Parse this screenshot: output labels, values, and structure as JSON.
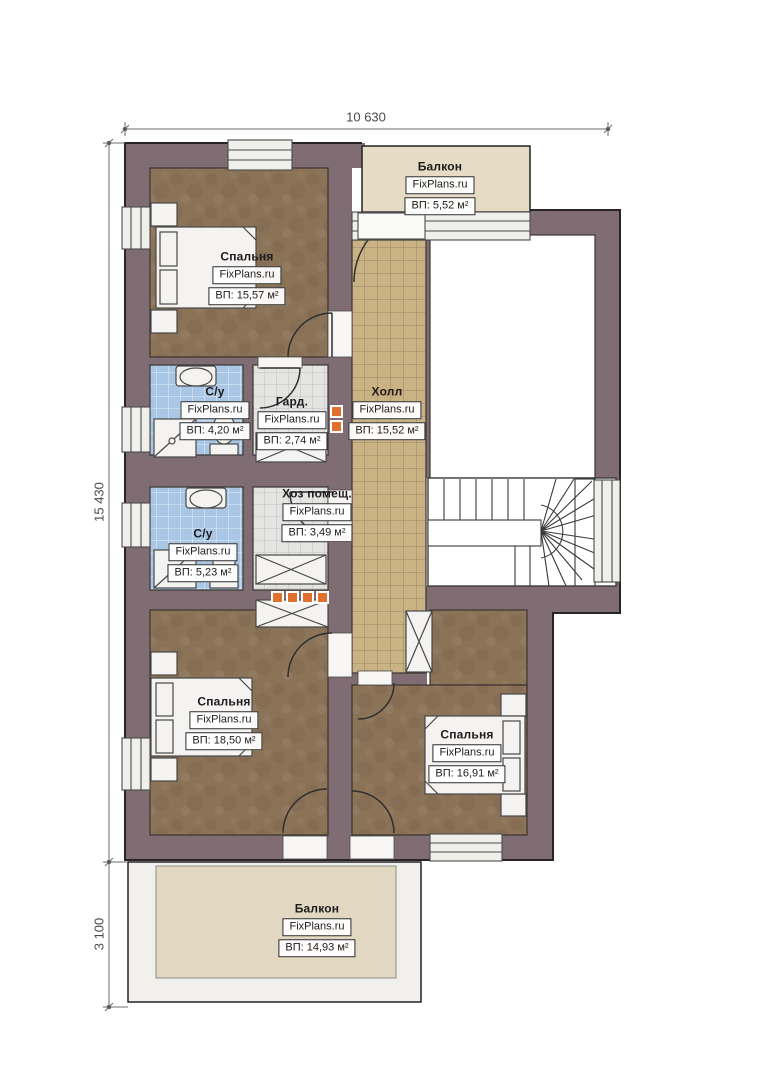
{
  "plan": {
    "dimensions": {
      "top": "10 630",
      "left": "15 430",
      "left_lower": "3 100"
    },
    "rooms": [
      {
        "id": "bedroom-top",
        "name": "Спальня",
        "watermark": "FixPlans.ru",
        "area": "ВП: 15,57 м²"
      },
      {
        "id": "balcony-top",
        "name": "Балкон",
        "watermark": "FixPlans.ru",
        "area": "ВП: 5,52 м²"
      },
      {
        "id": "bathroom-upper",
        "name": "С/у",
        "watermark": "FixPlans.ru",
        "area": "ВП: 4,20 м²"
      },
      {
        "id": "wardrobe",
        "name": "Гард.",
        "watermark": "FixPlans.ru",
        "area": "ВП: 2,74 м²"
      },
      {
        "id": "hall",
        "name": "Холл",
        "watermark": "FixPlans.ru",
        "area": "ВП: 15,52 м²"
      },
      {
        "id": "utility",
        "name": "Хоз помещ.",
        "watermark": "FixPlans.ru",
        "area": "ВП: 3,49 м²"
      },
      {
        "id": "bathroom-lower",
        "name": "С/у",
        "watermark": "FixPlans.ru",
        "area": "ВП: 5,23 м²"
      },
      {
        "id": "bedroom-bottom-left",
        "name": "Спальня",
        "watermark": "FixPlans.ru",
        "area": "ВП: 18,50 м²"
      },
      {
        "id": "bedroom-bottom-right",
        "name": "Спальня",
        "watermark": "FixPlans.ru",
        "area": "ВП: 16,91 м²"
      },
      {
        "id": "balcony-bottom",
        "name": "Балкон",
        "watermark": "FixPlans.ru",
        "area": "ВП: 14,93 м²"
      }
    ],
    "colors": {
      "wall": "#806c73",
      "floor_brown": "#8b7357",
      "tile_tan": "#c9b283",
      "tile_blue": "#a9c6e5",
      "tile_gray": "#e4e4e2",
      "balcony_beige": "#e6dcc5",
      "flue_orange": "#e2702d"
    }
  }
}
